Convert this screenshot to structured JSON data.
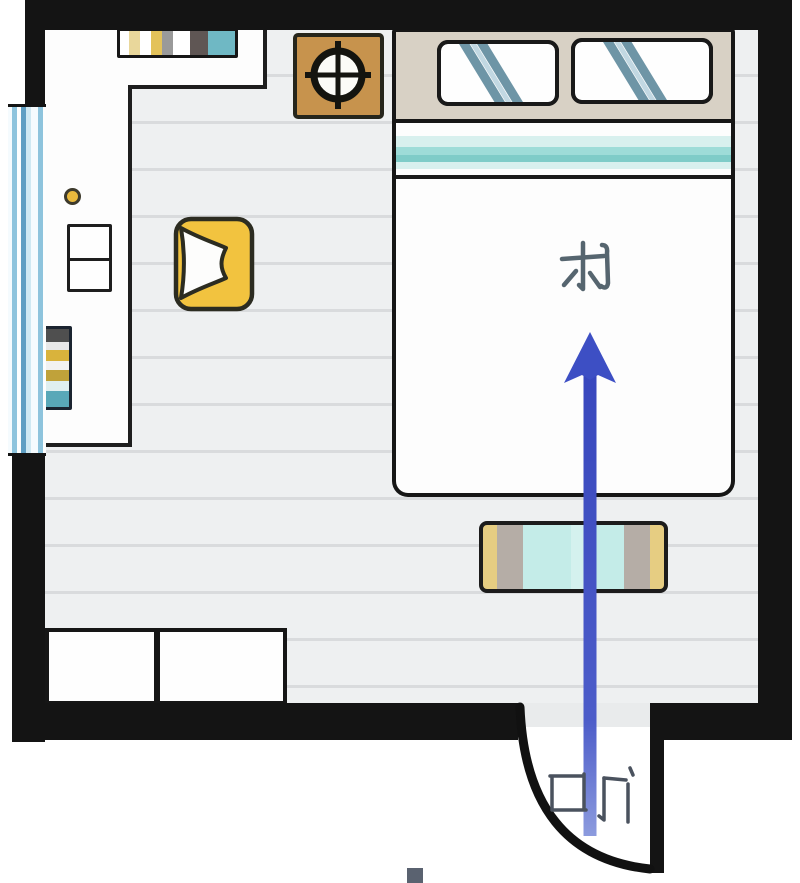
{
  "page": {
    "type": "bedroom-floor-plan",
    "background": "#ffffff"
  },
  "labels": {
    "bed_direction": "东",
    "doorway": "口门"
  },
  "arrow": {
    "direction": "up",
    "color": "#3d4fc4",
    "from": "doorway at bottom wall",
    "to": "bed direction label"
  },
  "colors": {
    "wall": "#141414",
    "floor": "#eef0f1",
    "floor_line": "#d9dbdd",
    "window_blue": "#5f9fc3",
    "headboard_beige": "#d8d1c5",
    "blanket_teal": "#7fccc8",
    "pillow_stripe_blue": "#6e95a6",
    "armchair_yellow": "#f2c33f",
    "side_table_brown": "#c7934d",
    "bench_cyan": "#c4ece8",
    "knob_yellow": "#e9b93d",
    "label_ink": "#56656f"
  },
  "furniture": {
    "items": [
      "top-bookshelf",
      "compass-side-table",
      "double-bed",
      "pillow-left",
      "pillow-right",
      "yellow-armchair",
      "white-cabinet",
      "book-stack",
      "window",
      "foot-bench",
      "storage-box-left",
      "storage-box-right",
      "door-swing"
    ]
  }
}
